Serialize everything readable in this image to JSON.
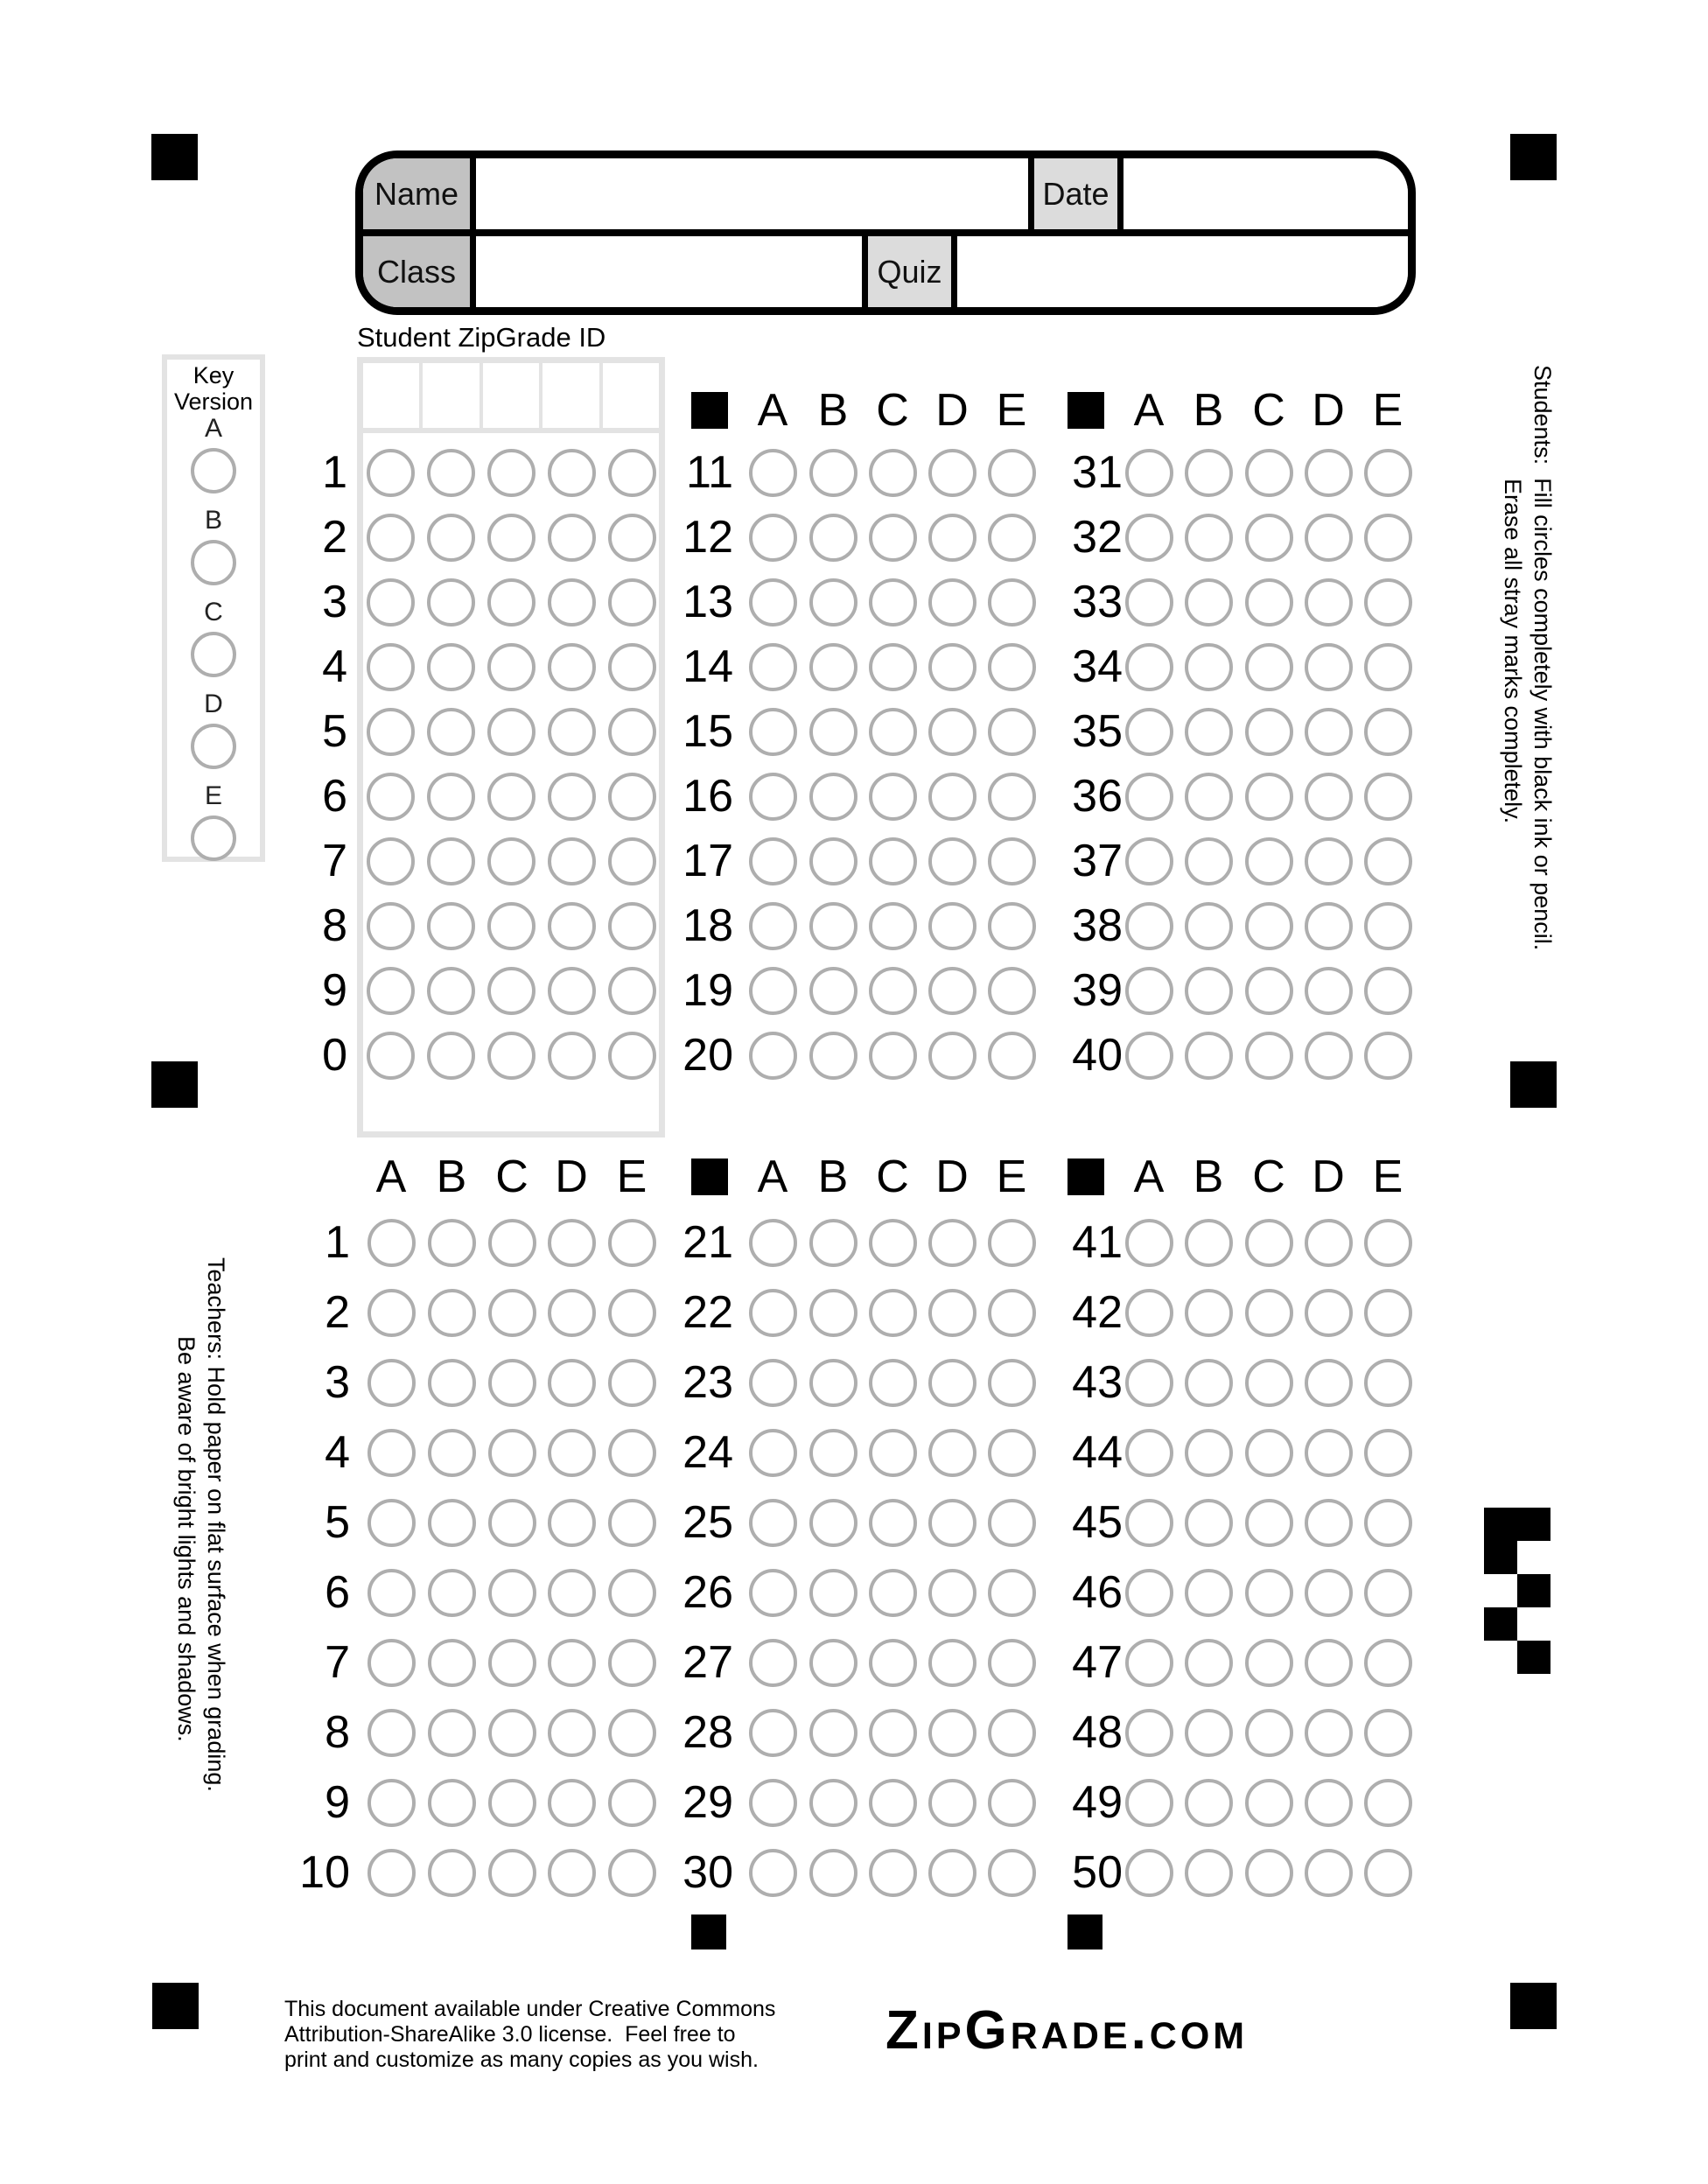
{
  "form": {
    "name_label": "Name",
    "name_value": "",
    "date_label": "Date",
    "date_value": "",
    "class_label": "Class",
    "class_value": "",
    "quiz_label": "Quiz",
    "quiz_value": ""
  },
  "student_id": {
    "title": "Student ZipGrade ID",
    "row_digits": [
      "1",
      "2",
      "3",
      "4",
      "5",
      "6",
      "7",
      "8",
      "9",
      "0"
    ],
    "write_in_cells": 5
  },
  "key_version": {
    "title_line1": "Key",
    "title_line2": "Version",
    "options": [
      "A",
      "B",
      "C",
      "D",
      "E"
    ]
  },
  "answers": {
    "letters": [
      "A",
      "B",
      "C",
      "D",
      "E"
    ]
  },
  "question_sections": [
    {
      "name": "q11-20",
      "area": "top",
      "column": "mid",
      "header_square": true,
      "numbers": [
        11,
        12,
        13,
        14,
        15,
        16,
        17,
        18,
        19,
        20
      ]
    },
    {
      "name": "q31-40",
      "area": "top",
      "column": "right",
      "header_square": true,
      "numbers": [
        31,
        32,
        33,
        34,
        35,
        36,
        37,
        38,
        39,
        40
      ]
    },
    {
      "name": "q1-10",
      "area": "bottom",
      "column": "left",
      "header_square": false,
      "numbers": [
        1,
        2,
        3,
        4,
        5,
        6,
        7,
        8,
        9,
        10
      ]
    },
    {
      "name": "q21-30",
      "area": "bottom",
      "column": "mid",
      "header_square": true,
      "numbers": [
        21,
        22,
        23,
        24,
        25,
        26,
        27,
        28,
        29,
        30
      ]
    },
    {
      "name": "q41-50",
      "area": "bottom",
      "column": "right",
      "header_square": true,
      "numbers": [
        41,
        42,
        43,
        44,
        45,
        46,
        47,
        48,
        49,
        50
      ]
    }
  ],
  "side_notes": {
    "students_line1": "Students:  Fill circles completely with black ink or pencil.",
    "students_line2": "Erase all stray marks completely.",
    "teachers_line1": "Teachers: Hold paper on flat surface when grading.",
    "teachers_line2": "Be aware of bright lights and shadows."
  },
  "footer": {
    "license_line1": "This document available under Creative Commons",
    "license_line2": "Attribution-ShareAlike 3.0 license.  Feel free to",
    "license_line3": "print and customize as many copies as you wish.",
    "logo_text": "ZipGrade.com"
  },
  "colors": {
    "black": "#000000",
    "label_dark_gray": "#c2c2c2",
    "label_light_gray": "#dcdcdc",
    "bubble_stroke": "#aeaeae",
    "frame_gray": "#e3e3e3"
  },
  "pattern_mark": [
    [
      1,
      1
    ],
    [
      1,
      0
    ],
    [
      0,
      1
    ],
    [
      1,
      0
    ],
    [
      0,
      1
    ]
  ]
}
